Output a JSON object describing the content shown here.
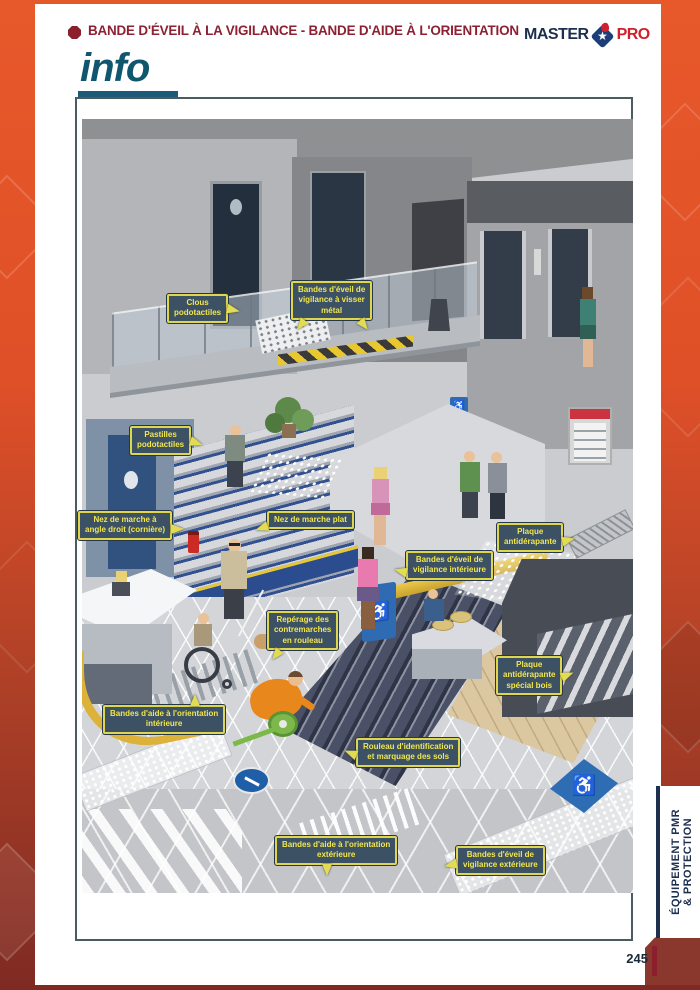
{
  "header": {
    "title": "BANDE D'ÉVEIL À LA VIGILANCE - BANDE D'AIDE À L'ORIENTATION",
    "info_label": "info"
  },
  "brand": {
    "master": "MASTER",
    "pro": "PRO"
  },
  "callouts": [
    {
      "id": "clous-podotactiles",
      "label": "Clous\npodotactiles"
    },
    {
      "id": "bandes-eveil-visser-metal",
      "label": "Bandes d'éveil de\nvigilance à visser\nmétal"
    },
    {
      "id": "pastilles-podotactiles",
      "label": "Pastilles\npodotactiles"
    },
    {
      "id": "nez-de-marche-angle-droit",
      "label": "Nez de marche à\nangle droit (cornière)"
    },
    {
      "id": "nez-de-marche-plat",
      "label": "Nez de marche plat"
    },
    {
      "id": "bandes-eveil-vigilance-interieure",
      "label": "Bandes d'éveil de\nvigilance intérieure"
    },
    {
      "id": "plaque-antiderapante",
      "label": "Plaque\nantidérapante"
    },
    {
      "id": "reperage-contremarches-rouleau",
      "label": "Repérage des\ncontremarches\nen rouleau"
    },
    {
      "id": "plaque-antiderapante-special-bois",
      "label": "Plaque\nantidérapante\nspécial bois"
    },
    {
      "id": "bandes-aide-orientation-interieure",
      "label": "Bandes d'aide à l'orientation\nintérieure"
    },
    {
      "id": "rouleau-identification-marquage",
      "label": "Rouleau d'identification\net marquage des sols"
    },
    {
      "id": "bandes-aide-orientation-exterieure",
      "label": "Bandes d'aide à l'orientation\nextérieure"
    },
    {
      "id": "bandes-eveil-vigilance-exterieure",
      "label": "Bandes d'éveil de\nvigilance extérieure"
    }
  ],
  "side_tab": {
    "line1": "ÉQUIPEMENT PMR",
    "line2": "& PROTECTION"
  },
  "footer": {
    "page_number": "245"
  },
  "icons": {
    "wheelchair": "♿",
    "star": "★"
  },
  "colors": {
    "frame_orange": "#e4592a",
    "frame_dark_red": "#7e2a23",
    "header_red": "#8e2033",
    "info_teal": "#10566e",
    "brand_navy": "#1c2f4e",
    "brand_red": "#d0202e",
    "callout_bg": "#3c5164",
    "callout_border": "#ded74e",
    "callout_text": "#f2e74e",
    "accent_yellow": "#e8c832",
    "accent_blue": "#2e6db4",
    "stair_blue": "#2b4c8f"
  }
}
